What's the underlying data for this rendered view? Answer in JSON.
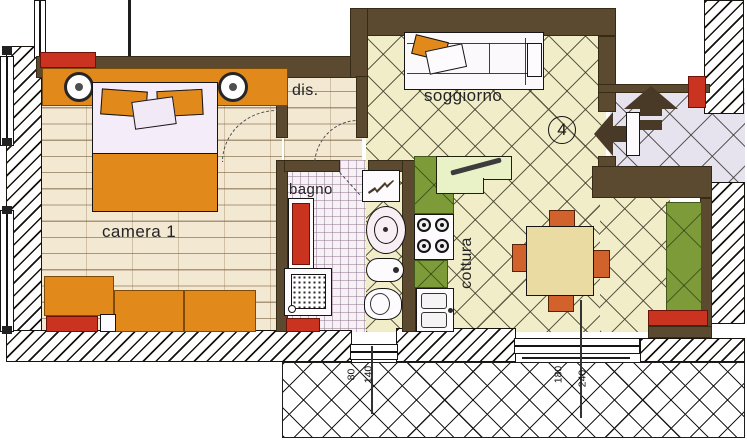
{
  "rooms": {
    "camera": {
      "label": "camera 1"
    },
    "dis": {
      "label": "dis."
    },
    "bagno": {
      "label": "bagno"
    },
    "soggiorno": {
      "label": "soggiorno"
    },
    "cottura": {
      "label": "cottura"
    }
  },
  "unit": {
    "number": "4"
  },
  "dimensions": {
    "bagno_window": {
      "width": "80",
      "height": "140"
    },
    "soggiorno_window": {
      "width": "180",
      "height": "240"
    }
  },
  "icons": {
    "entrance_up_arrow": "arrow-up",
    "entrance_left_arrow": "arrow-left"
  },
  "colors": {
    "wall": "#5b4a2f",
    "furniture_orange": "#e2891c",
    "chair_orange": "#d2622c",
    "radiator_red": "#c9331f",
    "cabinet_green": "#7d9c39",
    "counter_green": "#e9f2c6",
    "table_beige": "#e9dba2",
    "floor_camera": "#f3e8d2",
    "floor_soggiorno": "#f0edc8",
    "floor_landing": "#e6e2ee",
    "floor_bagno": "#f7f2f6",
    "arrow_dark": "#483a26"
  }
}
